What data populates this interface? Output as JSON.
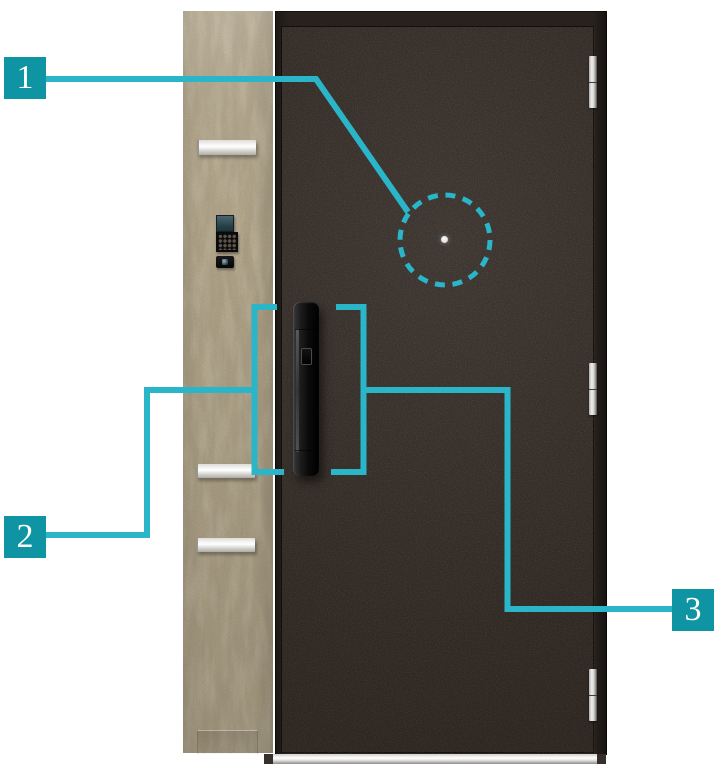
{
  "diagram": {
    "callouts": [
      {
        "number": "1"
      },
      {
        "number": "2"
      },
      {
        "number": "3"
      }
    ]
  },
  "colors": {
    "background": "#ffffff",
    "accent-line": "#2ab5c8",
    "accent-box": "#0e94a2",
    "door-leaf": "#342c26",
    "door-frame": "#28221f",
    "wood-base": "#b3a68a",
    "metal-silver": "#e9e8e5"
  }
}
